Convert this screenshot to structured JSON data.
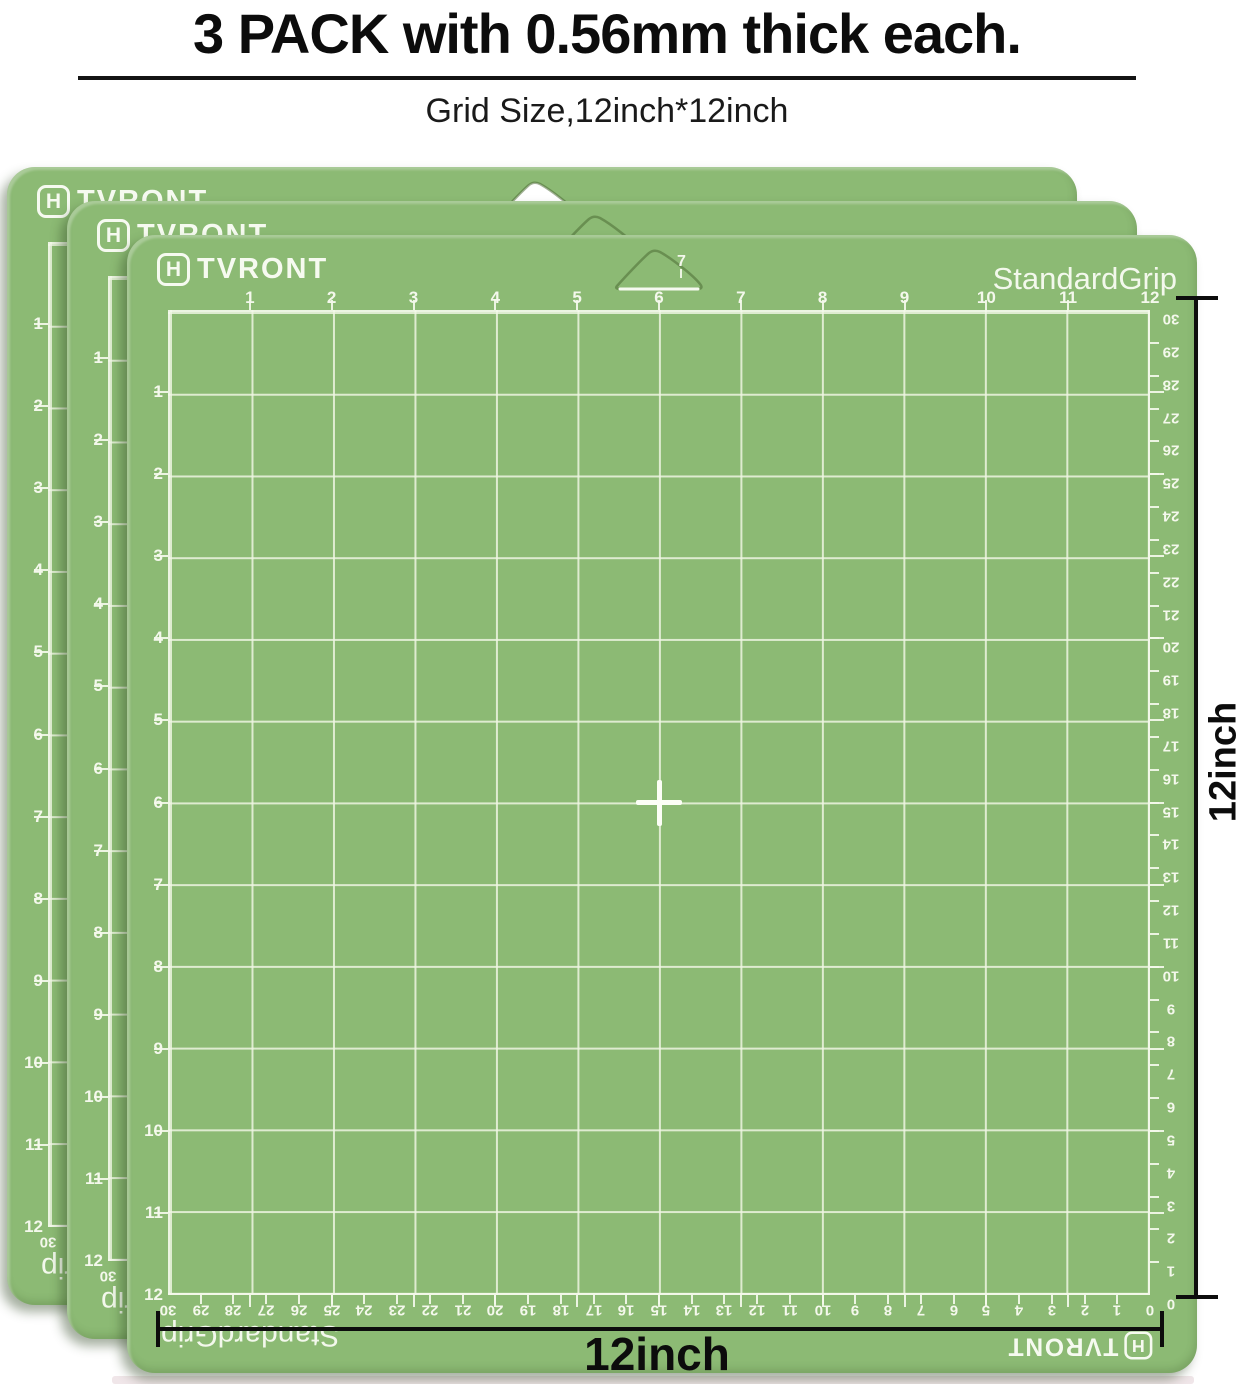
{
  "header": {
    "title": "3 PACK with 0.56mm thick each.",
    "subtitle": "Grid Size,12inch*12inch"
  },
  "mat": {
    "brand_icon": "H",
    "brand_text": "TVRONT",
    "brand_full": "HTVRONT",
    "grip": "StandardGrip",
    "top_inch_labels": [
      "1",
      "2",
      "3",
      "4",
      "5",
      "6",
      "7",
      "8",
      "9",
      "10",
      "11",
      "12"
    ],
    "left_inch_labels": [
      "1",
      "2",
      "3",
      "4",
      "5",
      "6",
      "7",
      "8",
      "9",
      "10",
      "11",
      "12"
    ],
    "cm_labels": [
      "30",
      "29",
      "28",
      "27",
      "26",
      "25",
      "24",
      "23",
      "22",
      "21",
      "20",
      "19",
      "18",
      "17",
      "16",
      "15",
      "14",
      "13",
      "12",
      "11",
      "10",
      "9",
      "8",
      "7",
      "6",
      "5",
      "4",
      "3",
      "2",
      "1",
      "0"
    ],
    "hole_peek_label": "7",
    "colors": {
      "mat_green": "#8cba74",
      "grid_line": "#f0f5e4",
      "label_text": "#f4f8ec"
    }
  },
  "dimensions": {
    "width_label": "12inch",
    "height_label": "12inch"
  },
  "pack": {
    "count_of_mats": 3
  }
}
